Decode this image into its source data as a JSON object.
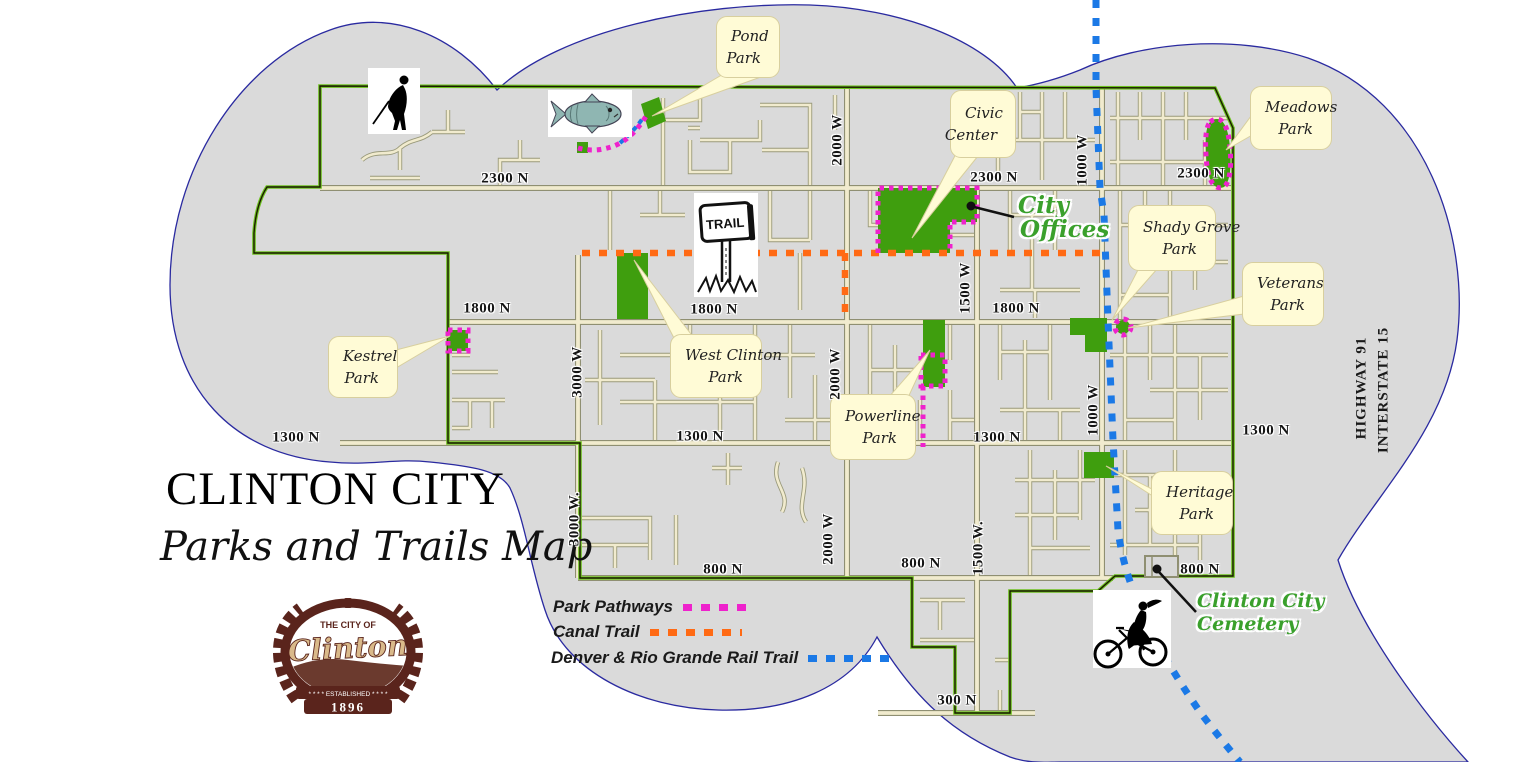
{
  "title": {
    "main": "CLINTON CITY",
    "subtitle": "Parks and Trails Map"
  },
  "logo": {
    "top_text": "THE CITY OF",
    "name": "Clinton",
    "banner": "* * * * ESTABLISHED * * * *",
    "year": "1896"
  },
  "legend": {
    "items": [
      {
        "label": "Park Pathways",
        "color_key": "pink_trail"
      },
      {
        "label": "Canal Trail",
        "color_key": "orange_trail"
      },
      {
        "label": "Denver & Rio Grande Rail Trail",
        "color_key": "blue_trail"
      }
    ]
  },
  "colors": {
    "pink_trail": "#ee22cc",
    "orange_trail": "#ff6a14",
    "blue_trail": "#1b79e6",
    "park_green": "#3f9e0e",
    "boundary_green": "#6cc01e",
    "boundary_dark": "#1a1a00",
    "road_fill": "#f1ebce",
    "road_casing": "#8f8f72",
    "cloud_fill": "#dadada",
    "cloud_stroke": "#2a2aa0",
    "callout_bg": "#fffbd6",
    "annotation_green": "#3aa02c",
    "logo_brown": "#5a241c"
  },
  "parks": [
    {
      "name": "pond-park",
      "line1": "Pond",
      "line2": "Park"
    },
    {
      "name": "civic-center",
      "line1": "Civic",
      "line2": "Center"
    },
    {
      "name": "meadows-park",
      "line1": "Meadows",
      "line2": "Park"
    },
    {
      "name": "shady-grove-park",
      "line1": "Shady Grove",
      "line2": "Park"
    },
    {
      "name": "veterans-park",
      "line1": "Veterans",
      "line2": "Park"
    },
    {
      "name": "kestrel-park",
      "line1": "Kestrel",
      "line2": "Park"
    },
    {
      "name": "west-clinton-park",
      "line1": "West Clinton",
      "line2": "Park"
    },
    {
      "name": "powerline-park",
      "line1": "Powerline",
      "line2": "Park"
    },
    {
      "name": "heritage-park",
      "line1": "Heritage",
      "line2": "Park"
    }
  ],
  "annotations": {
    "city_offices_1": "City",
    "city_offices_2": "Offices",
    "cemetery_1": "Clinton City",
    "cemetery_2": "Cemetery",
    "highway": "HIGHWAY 91",
    "interstate": "INTERSTATE 15"
  },
  "street_labels": [
    {
      "text": "2300 N",
      "x": 505,
      "y": 179,
      "rot": 0
    },
    {
      "text": "2300 N",
      "x": 994,
      "y": 178,
      "rot": 0
    },
    {
      "text": "2300 N",
      "x": 1201,
      "y": 174,
      "rot": 0
    },
    {
      "text": "1800 N",
      "x": 487,
      "y": 309,
      "rot": 0
    },
    {
      "text": "1800 N",
      "x": 714,
      "y": 310,
      "rot": 0
    },
    {
      "text": "1800 N",
      "x": 1016,
      "y": 309,
      "rot": 0
    },
    {
      "text": "1300 N",
      "x": 296,
      "y": 438,
      "rot": 0
    },
    {
      "text": "1300 N",
      "x": 700,
      "y": 437,
      "rot": 0
    },
    {
      "text": "1300 N",
      "x": 997,
      "y": 438,
      "rot": 0
    },
    {
      "text": "1300 N",
      "x": 1266,
      "y": 431,
      "rot": 0
    },
    {
      "text": "800 N",
      "x": 723,
      "y": 570,
      "rot": 0
    },
    {
      "text": "800 N",
      "x": 921,
      "y": 564,
      "rot": 0
    },
    {
      "text": "800 N",
      "x": 1200,
      "y": 570,
      "rot": 0
    },
    {
      "text": "300 N",
      "x": 957,
      "y": 701,
      "rot": 0
    },
    {
      "text": "3000 W",
      "x": 578,
      "y": 372,
      "rot": -90
    },
    {
      "text": "3000 W.",
      "x": 575,
      "y": 519,
      "rot": -90
    },
    {
      "text": "2000 W",
      "x": 838,
      "y": 140,
      "rot": -90
    },
    {
      "text": "2000 W",
      "x": 836,
      "y": 374,
      "rot": -90
    },
    {
      "text": "2000 W",
      "x": 829,
      "y": 539,
      "rot": -90
    },
    {
      "text": "1500 W",
      "x": 966,
      "y": 288,
      "rot": -90
    },
    {
      "text": "1500 W.",
      "x": 979,
      "y": 548,
      "rot": -90
    },
    {
      "text": "1000 W",
      "x": 1083,
      "y": 160,
      "rot": -90
    },
    {
      "text": "1000 W",
      "x": 1094,
      "y": 410,
      "rot": -90
    }
  ],
  "icons": [
    "golfer-icon",
    "fish-icon",
    "trail-sign-icon",
    "bicyclist-icon"
  ]
}
